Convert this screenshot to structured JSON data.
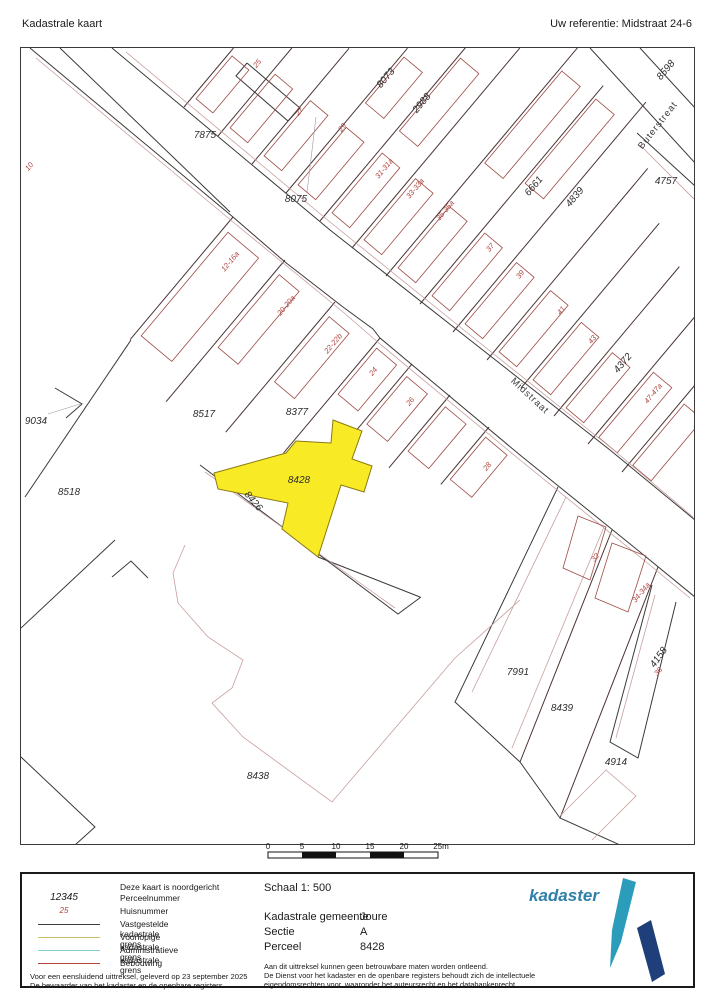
{
  "header": {
    "title": "Kadastrale kaart",
    "reference": "Uw referentie: Midstraat 24-6"
  },
  "map": {
    "highlight_parcel": "8428",
    "highlight_color": "#f9ea26",
    "streets": [
      {
        "label": "Midstraat"
      },
      {
        "label": "Buterstreat"
      }
    ],
    "parcels": [
      {
        "label": "7875"
      },
      {
        "label": "8075"
      },
      {
        "label": "8073"
      },
      {
        "label": "2988"
      },
      {
        "label": "6661"
      },
      {
        "label": "4839"
      },
      {
        "label": "8598"
      },
      {
        "label": "4757"
      },
      {
        "label": "4372"
      },
      {
        "label": "9034"
      },
      {
        "label": "8517"
      },
      {
        "label": "8377"
      },
      {
        "label": "8428"
      },
      {
        "label": "8426"
      },
      {
        "label": "8518"
      },
      {
        "label": "8438"
      },
      {
        "label": "7991"
      },
      {
        "label": "8439"
      },
      {
        "label": "4914"
      },
      {
        "label": "4158"
      }
    ],
    "house_numbers": [
      {
        "label": "10"
      },
      {
        "label": "25"
      },
      {
        "label": "27"
      },
      {
        "label": "29"
      },
      {
        "label": "31-31a"
      },
      {
        "label": "33-33a"
      },
      {
        "label": "35-35a"
      },
      {
        "label": "37"
      },
      {
        "label": "39"
      },
      {
        "label": "41"
      },
      {
        "label": "43"
      },
      {
        "label": "47-47a"
      },
      {
        "label": "12-16a"
      },
      {
        "label": "20-20a"
      },
      {
        "label": "22-22b"
      },
      {
        "label": "24"
      },
      {
        "label": "26"
      },
      {
        "label": "28"
      },
      {
        "label": "32"
      },
      {
        "label": "34-34a"
      },
      {
        "label": "36"
      }
    ]
  },
  "scale_bar": {
    "ticks": [
      "0",
      "5",
      "10",
      "15",
      "20",
      "25m"
    ]
  },
  "legend": {
    "north_note": "Deze kaart is noordgericht",
    "items": [
      {
        "sample": "12345",
        "label": "Perceelnummer"
      },
      {
        "sample": "25",
        "label": "Huisnummer"
      },
      {
        "swatch": "#3c3c3c",
        "label": "Vastgestelde kadastrale grens"
      },
      {
        "swatch": "#cdbf63",
        "label": "Voorlopige kadastrale grens"
      },
      {
        "swatch": "#7fd0d0",
        "label": "Administratieve kadastrale grens"
      },
      {
        "swatch": "#b0433c",
        "label": "Bebouwing"
      }
    ],
    "footer_line1": "Voor een eensluidend uittreksel, geleverd op 23 september 2025",
    "footer_line2": "De bewaarder van het kadaster en de openbare registers"
  },
  "details": {
    "schaal": "Schaal 1: 500",
    "rows": [
      {
        "label": "Kadastrale gemeente",
        "value": "Joure"
      },
      {
        "label": "Sectie",
        "value": "A"
      },
      {
        "label": "Perceel",
        "value": "8428"
      }
    ],
    "disclaimer": [
      "Aan dit uittreksel kunnen geen betrouwbare maten worden ontleend.",
      "De Dienst voor het kadaster en de openbare registers behoudt zich de intellectuele",
      "eigendomsrechten voor, waaronder het auteursrecht en het databankenrecht."
    ]
  },
  "logo": {
    "text": "kadaster"
  }
}
